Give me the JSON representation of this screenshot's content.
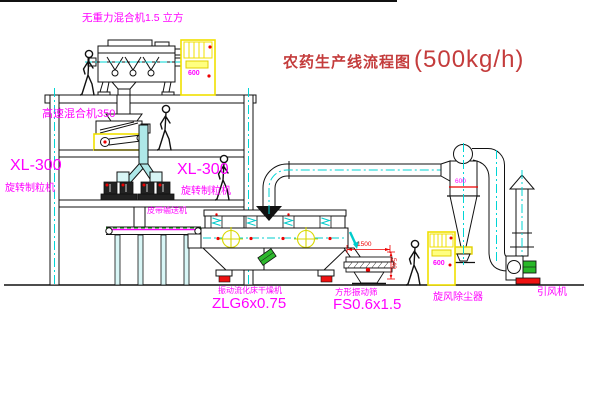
{
  "title": {
    "name": "农药生产线流程图",
    "capacity": "(500kg/h)"
  },
  "equipment_labels": {
    "gravity_mixer": "无重力混合机1.5 立方",
    "high_speed_mixer": "高速混合机350",
    "granulator_left": {
      "model": "XL-300",
      "name": "旋转制粒机"
    },
    "granulator_right": {
      "model": "XL-300",
      "name": "旋转制粒机"
    },
    "belt_conveyor": "皮带输送机",
    "fluid_bed_dryer": {
      "name": "振动流化床干燥机",
      "model": "ZLG6x0.75"
    },
    "vibrating_sieve": {
      "name": "方形振动筛",
      "model": "FS0.6x1.5"
    },
    "cyclone": "旋风除尘器",
    "induced_draft_fan": "引风机"
  },
  "dimensions": {
    "sieve_length": "1500",
    "sieve_height": "540",
    "cyclone_marking": "600"
  },
  "cabinets": {
    "top_panel_text": "600",
    "right_panel_text": "600"
  },
  "colors": {
    "label": "#ff00ff",
    "title": "#c43c3c",
    "dimension": "#ee0000",
    "centerline": "#00d5d5",
    "highlight": "#f0e000"
  }
}
